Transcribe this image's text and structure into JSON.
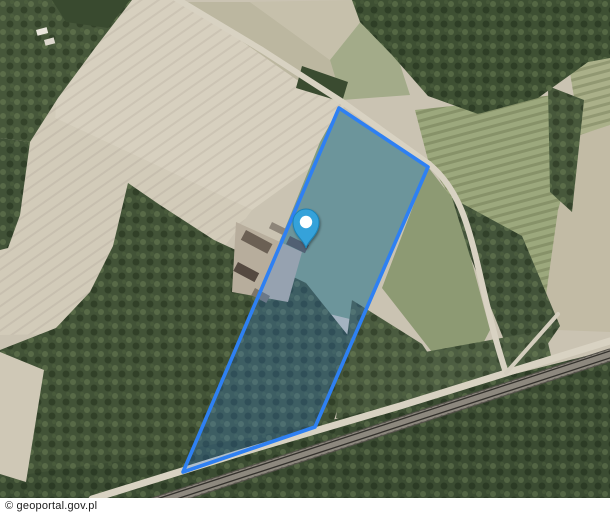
{
  "map": {
    "attribution": "© geoportal.gov.pl",
    "parcel": {
      "points": "339,108 428,167 315,427 183,472",
      "stroke": "#2e80f3",
      "stroke_width": 3.6,
      "fill": "rgba(46,128,243,0.24)"
    },
    "marker": {
      "x": 306,
      "y": 248,
      "color": "#34a2da",
      "border": "#1f82b4",
      "dot_color": "#ffffff"
    },
    "scene": {
      "features": [
        {
          "name": "base-field",
          "type": "rect",
          "x": 0,
          "y": 0,
          "w": 610,
          "h": 515,
          "fill": "#cac3b2"
        },
        {
          "name": "field-pale-nw",
          "type": "polygon",
          "points": "88,0 180,0 345,102 332,152 252,210 55,118 60,40",
          "fill": "#d7d0bf",
          "pattern": "harrow"
        },
        {
          "name": "field-pale-w",
          "type": "polygon",
          "points": "0,60 60,40 55,118 252,210 160,332 0,335",
          "fill": "#d2cbb9",
          "pattern": "harrow"
        },
        {
          "name": "field-ne-road-1",
          "type": "polygon",
          "points": "186,2 250,2 330,60 342,100 300,82 240,40",
          "fill": "#bcb7a0"
        },
        {
          "name": "field-ne-road-2",
          "type": "polygon",
          "points": "250,2 355,0 362,20 330,60",
          "fill": "#c6c0ab"
        },
        {
          "name": "field-ne-green",
          "type": "polygon",
          "points": "330,60 362,20 398,58 410,95 342,100",
          "fill": "#a3ab89"
        },
        {
          "name": "field-rows-east",
          "type": "polygon",
          "points": "415,110 555,95 580,205 558,322 502,302 455,205 428,160",
          "fill": "#9ca87d",
          "pattern": "rows"
        },
        {
          "name": "field-tan-east",
          "type": "polygon",
          "points": "580,135 610,125 610,332 558,330 545,302 558,210",
          "fill": "#c2bba5"
        },
        {
          "name": "field-rows-ne",
          "type": "polygon",
          "points": "585,0 610,0 610,125 580,135 568,60",
          "fill": "#aab089",
          "pattern": "rows"
        },
        {
          "name": "field-olive-strip",
          "type": "polygon",
          "points": "428,167 452,198 470,255 490,330 460,388 432,352 382,288",
          "fill": "#8d9a73"
        },
        {
          "name": "meadow-in-parcel",
          "type": "polygon",
          "points": "339,108 428,167 362,322 256,296 286,226 320,142",
          "fill": "#809b80"
        },
        {
          "name": "forest-nw",
          "type": "polygon",
          "points": "0,0 132,0 95,48 58,98 30,142 0,138",
          "fill": "#46573a",
          "pattern": "canopy"
        },
        {
          "name": "forest-nw-dark",
          "type": "polygon",
          "points": "52,0 130,0 108,28 66,22",
          "fill": "#394a2f"
        },
        {
          "name": "forest-west-strip",
          "type": "polygon",
          "points": "0,138 30,142 20,215 8,248 0,250",
          "fill": "#415237",
          "pattern": "canopy"
        },
        {
          "name": "forest-ne",
          "type": "polygon",
          "points": "352,0 610,0 610,58 588,62 538,98 478,114 428,96 392,55 360,22",
          "fill": "#3e5033",
          "pattern": "canopy"
        },
        {
          "name": "forest-ne-arm",
          "type": "polygon",
          "points": "548,86 584,100 572,212 550,192",
          "fill": "#47583b",
          "pattern": "canopy"
        },
        {
          "name": "forest-road-clump",
          "type": "polygon",
          "points": "302,66 348,82 342,102 296,88",
          "fill": "#3a4b30"
        },
        {
          "name": "forest-central",
          "type": "polygon",
          "points": "128,183 160,205 214,240 266,264 306,283 358,348 331,429 282,449 231,465 186,472 148,502 0,502 0,350 56,328 90,292 113,246",
          "fill": "#425337",
          "pattern": "canopy"
        },
        {
          "name": "forest-scrub-east",
          "type": "polygon",
          "points": "352,300 422,344 466,410 428,432 336,418",
          "fill": "#4a5b3f",
          "pattern": "canopy"
        },
        {
          "name": "forest-railside",
          "type": "polygon",
          "points": "452,198 522,236 560,326 538,358 504,340 470,256",
          "fill": "#43543a",
          "pattern": "canopy"
        },
        {
          "name": "forest-rail-ne",
          "type": "polygon",
          "points": "425,352 545,330 552,360 505,376 432,394",
          "fill": "#4d5e42",
          "pattern": "canopy"
        },
        {
          "name": "forest-south-railway",
          "type": "polygon",
          "points": "0,478 130,460 300,428 610,350 610,515 0,515",
          "fill": "#3b4c32",
          "pattern": "canopy"
        },
        {
          "name": "field-wedge-sw",
          "type": "polygon",
          "points": "0,352 44,370 26,482 0,474",
          "fill": "#cfc8b6"
        },
        {
          "name": "farmyard",
          "type": "polygon",
          "points": "236,222 302,252 288,302 232,292",
          "fill": "#b7ad9c"
        },
        {
          "name": "building",
          "type": "rect",
          "x": 246,
          "y": 230,
          "w": 30,
          "h": 11,
          "rot": 28,
          "fill": "#6b6054"
        },
        {
          "name": "building",
          "type": "rect",
          "x": 238,
          "y": 262,
          "w": 24,
          "h": 10,
          "rot": 28,
          "fill": "#544940"
        },
        {
          "name": "building",
          "type": "rect",
          "x": 255,
          "y": 288,
          "w": 17,
          "h": 8,
          "rot": 28,
          "fill": "#7d7568"
        },
        {
          "name": "building",
          "type": "rect",
          "x": 290,
          "y": 236,
          "w": 21,
          "h": 9,
          "rot": 26,
          "fill": "#5d564c"
        },
        {
          "name": "building",
          "type": "rect",
          "x": 272,
          "y": 222,
          "w": 15,
          "h": 7,
          "rot": 26,
          "fill": "#8d8579"
        },
        {
          "name": "building",
          "type": "rect",
          "x": 36,
          "y": 30,
          "w": 11,
          "h": 6,
          "rot": -15,
          "fill": "#e9e5db"
        },
        {
          "name": "building",
          "type": "rect",
          "x": 44,
          "y": 40,
          "w": 10,
          "h": 6,
          "rot": -15,
          "fill": "#ddd8cd"
        },
        {
          "name": "road-top",
          "type": "path",
          "d": "M172,-4 L262,50 L341,101 L429,164",
          "stroke": "#d8d2c2",
          "width": 6
        },
        {
          "name": "road-east-curve",
          "type": "path",
          "d": "M429,164 C458,188 468,224 477,262 C485,296 492,330 506,373",
          "stroke": "#d8d2c2",
          "width": 6
        },
        {
          "name": "road-south",
          "type": "path",
          "d": "M92,499 L240,453 L400,406 L506,373 L610,341",
          "stroke": "#d8d2c2",
          "width": 7
        },
        {
          "name": "road-spur",
          "type": "path",
          "d": "M506,373 L558,314",
          "stroke": "#d3cdbd",
          "width": 4
        },
        {
          "name": "railway-bed",
          "type": "path",
          "d": "M116,516 L610,355",
          "stroke": "#55524b",
          "width": 13
        },
        {
          "name": "railway-ties",
          "type": "path",
          "d": "M116,516 L610,355",
          "stroke": "#8d887e",
          "width": 11,
          "dash": "2 5"
        },
        {
          "name": "railway-rail",
          "type": "path",
          "d": "M117,512 L610,351",
          "stroke": "#34322d",
          "width": 1.3
        },
        {
          "name": "railway-rail",
          "type": "path",
          "d": "M115,519 L610,358",
          "stroke": "#34322d",
          "width": 1.3
        }
      ]
    }
  }
}
